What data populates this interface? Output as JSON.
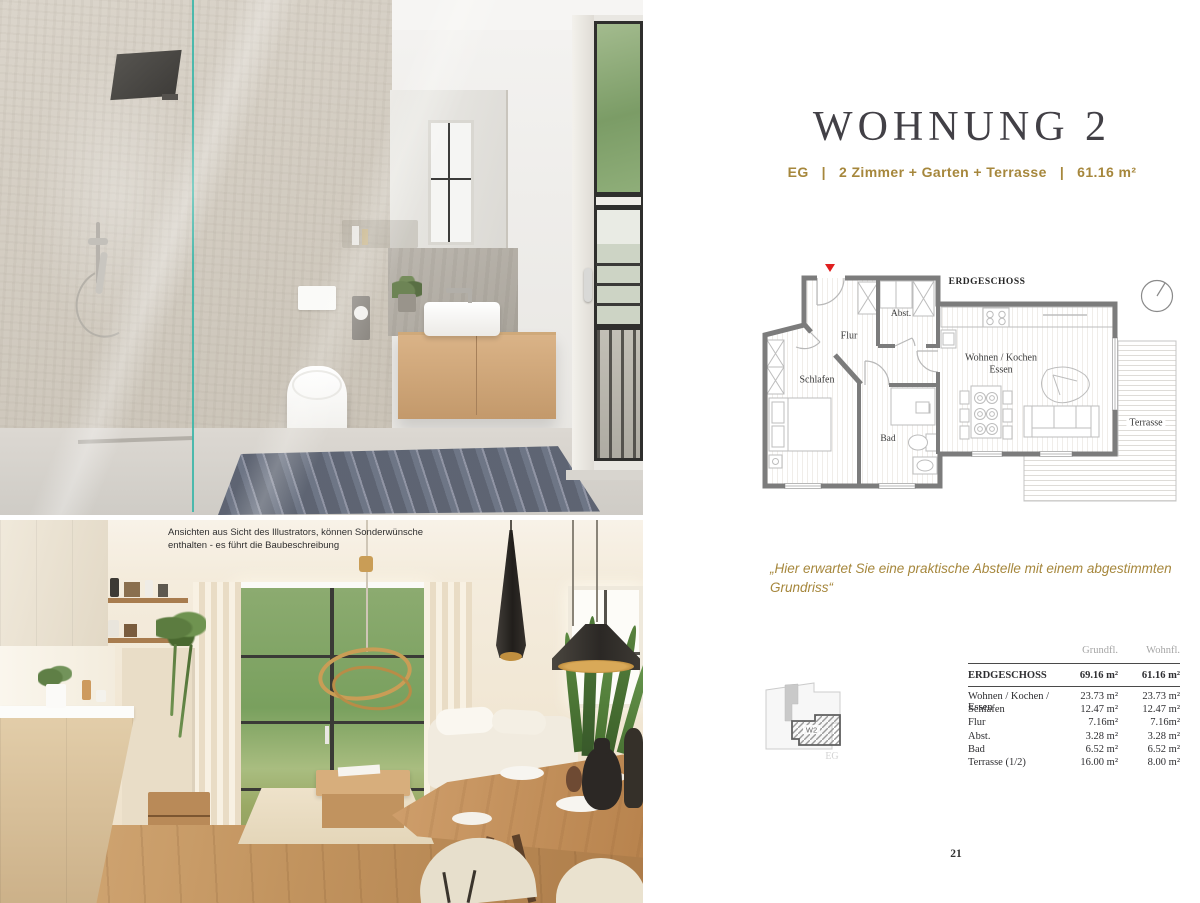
{
  "page": {
    "title": "WOHNUNG 2",
    "page_number": "21"
  },
  "subtitle": {
    "floor": "EG",
    "separator": "|",
    "rooms": "2 Zimmer + Garten + Terrasse",
    "area": "61.16 m²"
  },
  "photos": {
    "disclaimer_lines": [
      "Ansichten aus Sicht des Illustrators, können Sonderwünsche",
      "enthalten - es führt die Baubeschreibung"
    ]
  },
  "quote": "„Hier erwartet Sie eine praktische Abstelle mit einem abgestimmten Grundriss“",
  "floorplan": {
    "title": "ERDGESCHOSS",
    "rooms": {
      "flur": "Flur",
      "abst": "Abst.",
      "schlafen": "Schlafen",
      "bad": "Bad",
      "wohnen_line1": "Wohnen / Kochen",
      "wohnen_line2": "Essen",
      "terrasse": "Terrasse"
    }
  },
  "locator": {
    "unit": "W2",
    "floor_label": "EG"
  },
  "area_table": {
    "col1_header": "Grundfl.",
    "col2_header": "Wohnfl.",
    "total": {
      "label": "ERDGESCHOSS",
      "grundfl": "69.16 m²",
      "wohnfl": "61.16 m²"
    },
    "rows": [
      {
        "label": "Wohnen / Kochen / Essen",
        "grundfl": "23.73 m²",
        "wohnfl": "23.73 m²"
      },
      {
        "label": "Schlafen",
        "grundfl": "12.47 m²",
        "wohnfl": "12.47 m²"
      },
      {
        "label": "Flur",
        "grundfl": "7.16m²",
        "wohnfl": "7.16m²"
      },
      {
        "label": "Abst.",
        "grundfl": "3.28 m²",
        "wohnfl": "3.28 m²"
      },
      {
        "label": "Bad",
        "grundfl": "6.52 m²",
        "wohnfl": "6.52 m²"
      },
      {
        "label": "Terrasse (1/2)",
        "grundfl": "16.00 m²",
        "wohnfl": "8.00 m²"
      }
    ]
  },
  "colors": {
    "accent_gold": "#a6873c",
    "title_gray": "#424046",
    "plan_wall_gray": "#7c7c7c",
    "plan_furniture_gray": "#bdbdbd",
    "table_text": "#2e2e31",
    "table_header_gray": "#a6a6a6",
    "entrance_marker_red": "#e01f1f",
    "shower_glass_teal": "#3cb6a9"
  }
}
